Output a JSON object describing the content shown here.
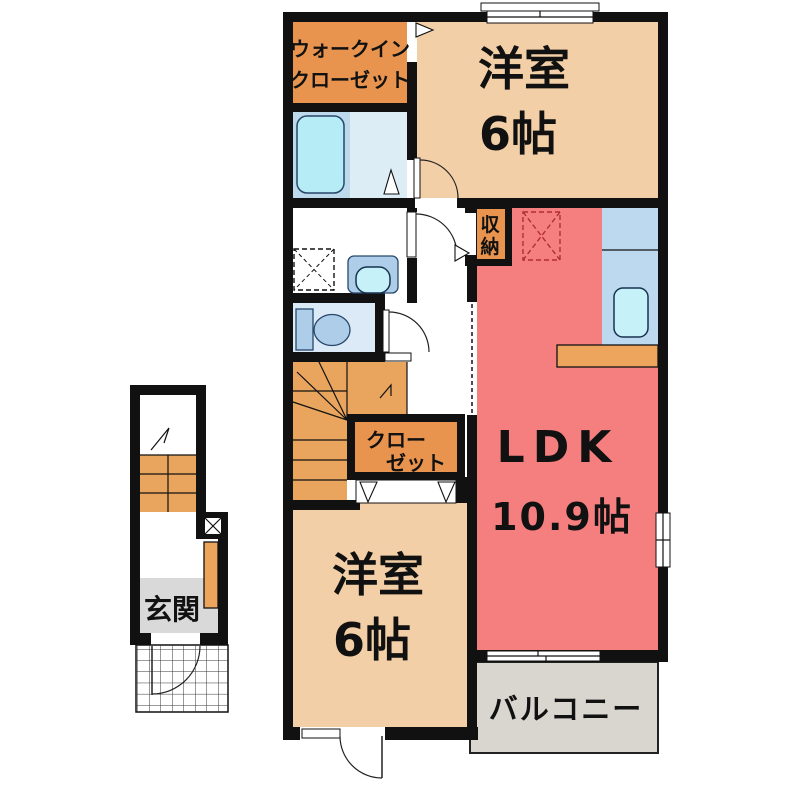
{
  "floorplan": {
    "type": "japanese-apartment-floor-plan",
    "colors": {
      "wall": "#111111",
      "bedroom_beige": "#f2cfa6",
      "closet_orange": "#e8944e",
      "stairs_orange": "#e9a55d",
      "ldk_red": "#f57f7f",
      "counter_orange": "#eda55e",
      "balcony_gray": "#d9d5cf",
      "entrance_gray": "#d9d9d9",
      "bath_floor_blue": "#bdd9ec",
      "bath_floor_light": "#dcedf6",
      "bathtub_cyan": "#b6ecf5",
      "toilet_floor_blue": "#dce9f7",
      "fixture_blue": "#aecde8",
      "kitchen_blue": "#bcd9f0",
      "sink_cyan": "#c6f1f9"
    },
    "labels": {
      "walkin_line1": "ウォークイン",
      "walkin_line2": "クローゼット",
      "bedroom_top_name": "洋室",
      "bedroom_top_size": "6帖",
      "storage_char1": "収",
      "storage_char2": "納",
      "closet_line1": "クロー",
      "closet_line2": "ゼット",
      "ldk_name": "LDK",
      "ldk_size": "10.9帖",
      "bedroom_bottom_name": "洋室",
      "bedroom_bottom_size": "6帖",
      "balcony": "バルコニー",
      "entrance": "玄関"
    }
  }
}
